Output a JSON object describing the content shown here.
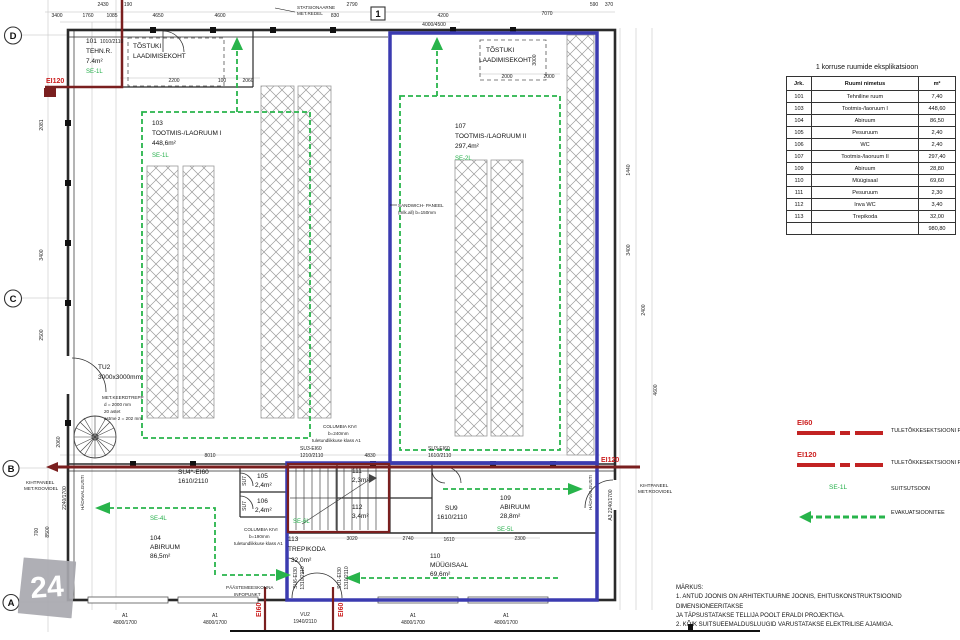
{
  "colors": {
    "section_blue": "#3b3bb0",
    "fire_barrier_maroon": "#7a1f1f",
    "fire_label_red": "#cc2020",
    "evacuation_green": "#28b44b",
    "rack_gray": "#999999"
  },
  "watermark": "24",
  "table": {
    "title": "1 korruse ruumide eksplikatsioon",
    "headers": [
      "Jrk.",
      "Ruumi nimetus",
      "m²"
    ],
    "rows": [
      [
        "101",
        "Tehniline ruum",
        "7,40"
      ],
      [
        "103",
        "Tootmis-/laoruum I",
        "448,60"
      ],
      [
        "104",
        "Abiruum",
        "86,50"
      ],
      [
        "105",
        "Pesuruum",
        "2,40"
      ],
      [
        "106",
        "WC",
        "2,40"
      ],
      [
        "107",
        "Tootmis-/laoruum II",
        "297,40"
      ],
      [
        "109",
        "Abiruum",
        "28,80"
      ],
      [
        "110",
        "Müügisaal",
        "69,60"
      ],
      [
        "111",
        "Pesuruum",
        "2,30"
      ],
      [
        "112",
        "Inva WC",
        "3,40"
      ],
      [
        "113",
        "Trepikoda",
        "32,00"
      ]
    ],
    "total": "980,80"
  },
  "legend": {
    "items": [
      {
        "code": "EI60",
        "label": "TULETÕKKESEKTSIOONI PIIR"
      },
      {
        "code": "EI120",
        "label": "TULETÕKKESEKTSIOONI PIIR"
      },
      {
        "code": "SE-1L",
        "label": "SUITSUTSOON"
      },
      {
        "code": "",
        "label": "EVAKUATSIOONITEE"
      }
    ]
  },
  "notes": {
    "heading": "MÄRKUS:",
    "lines": [
      "1. ANTUD JOONIS ON ARHITEKTUURNE JOONIS, EHITUSKONSTRUKTSIOONID DIMENSIONEERITAKSE",
      "JA TÄPSUSTATAKSE TELLIJA POOLT ERALDI PROJEKTIGA.",
      "2. KÕIK SUITSUEEMALDUSLUUGID VARUSTATAKSE ELEKTRILISE AJAMIGA."
    ]
  },
  "plan_labels": [
    {
      "t": "D",
      "x": 13,
      "y": 39,
      "c": "grid",
      "m": 1
    },
    {
      "t": "C",
      "x": 13,
      "y": 302,
      "c": "grid",
      "m": 1
    },
    {
      "t": "B",
      "x": 11,
      "y": 472,
      "c": "grid",
      "m": 1
    },
    {
      "t": "A",
      "x": 11,
      "y": 606,
      "c": "grid",
      "m": 1
    },
    {
      "t": "1",
      "x": 378,
      "y": 17,
      "c": "grid",
      "m": 1
    },
    {
      "t": "STATSIONAARNE",
      "x": 297,
      "y": 9,
      "c": "tiny"
    },
    {
      "t": "MET.REDEL",
      "x": 297,
      "y": 15,
      "c": "tiny"
    },
    {
      "t": "101",
      "x": 86,
      "y": 43,
      "c": "rm"
    },
    {
      "t": "1010/2110",
      "x": 100,
      "y": 43,
      "c": "dim"
    },
    {
      "t": "TEHN.R.",
      "x": 86,
      "y": 53,
      "c": "rm"
    },
    {
      "t": "7.4m²",
      "x": 86,
      "y": 63,
      "c": "rm"
    },
    {
      "t": "SE-1L",
      "x": 86,
      "y": 73,
      "c": "grn"
    },
    {
      "t": "TÕSTUKI",
      "x": 133,
      "y": 48,
      "c": "rm"
    },
    {
      "t": "LAADIMISEKOHT",
      "x": 133,
      "y": 58,
      "c": "rm"
    },
    {
      "t": "TÕSTUKI",
      "x": 486,
      "y": 52,
      "c": "rm"
    },
    {
      "t": "LAADIMISEKOHT",
      "x": 479,
      "y": 62,
      "c": "rm"
    },
    {
      "t": "103",
      "x": 152,
      "y": 125,
      "c": "rm"
    },
    {
      "t": "TOOTMIS-/LAORUUM I",
      "x": 152,
      "y": 135,
      "c": "rm"
    },
    {
      "t": "448,6m²",
      "x": 152,
      "y": 145,
      "c": "rm"
    },
    {
      "t": "SE-1L",
      "x": 152,
      "y": 157,
      "c": "grn"
    },
    {
      "t": "107",
      "x": 455,
      "y": 128,
      "c": "rm"
    },
    {
      "t": "TOOTMIS-/LAORUUM II",
      "x": 455,
      "y": 138,
      "c": "rm"
    },
    {
      "t": "297,4m²",
      "x": 455,
      "y": 148,
      "c": "rm"
    },
    {
      "t": "SE-2L",
      "x": 455,
      "y": 160,
      "c": "grn"
    },
    {
      "t": "104",
      "x": 150,
      "y": 540,
      "c": "rm"
    },
    {
      "t": "ABIRUUM",
      "x": 150,
      "y": 549,
      "c": "rm"
    },
    {
      "t": "86,5m²",
      "x": 150,
      "y": 558,
      "c": "rm"
    },
    {
      "t": "SE-4L",
      "x": 150,
      "y": 520,
      "c": "grn"
    },
    {
      "t": "113",
      "x": 288,
      "y": 541,
      "c": "rm"
    },
    {
      "t": "TREPIKODA",
      "x": 288,
      "y": 551,
      "c": "rm"
    },
    {
      "t": "32,0m²",
      "x": 291,
      "y": 562,
      "c": "rm"
    },
    {
      "t": "SE-6L",
      "x": 293,
      "y": 523,
      "c": "grn"
    },
    {
      "t": "109",
      "x": 500,
      "y": 500,
      "c": "rm"
    },
    {
      "t": "ABIRUUM",
      "x": 500,
      "y": 509,
      "c": "rm"
    },
    {
      "t": "28,8m²",
      "x": 500,
      "y": 518,
      "c": "rm"
    },
    {
      "t": "SE-5L",
      "x": 497,
      "y": 531,
      "c": "grn"
    },
    {
      "t": "110",
      "x": 430,
      "y": 558,
      "c": "rm"
    },
    {
      "t": "MÜÜGISAAL",
      "x": 430,
      "y": 567,
      "c": "rm"
    },
    {
      "t": "69,6m²",
      "x": 430,
      "y": 576,
      "c": "rm"
    },
    {
      "t": "111",
      "x": 352,
      "y": 473,
      "c": "rm"
    },
    {
      "t": "2,3m²",
      "x": 352,
      "y": 482,
      "c": "rm"
    },
    {
      "t": "112",
      "x": 352,
      "y": 509,
      "c": "rm"
    },
    {
      "t": "3,4m²",
      "x": 352,
      "y": 518,
      "c": "rm"
    },
    {
      "t": "105",
      "x": 257,
      "y": 478,
      "c": "rm"
    },
    {
      "t": "2,4m²",
      "x": 255,
      "y": 487,
      "c": "rm"
    },
    {
      "t": "106",
      "x": 257,
      "y": 503,
      "c": "rm"
    },
    {
      "t": "2,4m²",
      "x": 255,
      "y": 512,
      "c": "rm"
    },
    {
      "t": "TU2",
      "x": 98,
      "y": 369,
      "c": "rm"
    },
    {
      "t": "3000x3000mm",
      "x": 98,
      "y": 379,
      "c": "rm"
    },
    {
      "t": "MET.KEERDTREPP",
      "x": 102,
      "y": 399,
      "c": "tiny"
    },
    {
      "t": "d = 2000 mm",
      "x": 104,
      "y": 406,
      "c": "tiny"
    },
    {
      "t": "20 astet",
      "x": 104,
      "y": 413,
      "c": "tiny"
    },
    {
      "t": "astme 2 = 202 mm",
      "x": 104,
      "y": 420,
      "c": "tiny"
    },
    {
      "t": "SANDWICH- PANEEL",
      "x": 398,
      "y": 207,
      "c": "tiny"
    },
    {
      "t": "(mlk.all) b=150mm",
      "x": 398,
      "y": 214,
      "c": "tiny"
    },
    {
      "t": "COLUMBIA KIVI",
      "x": 323,
      "y": 428,
      "c": "tiny"
    },
    {
      "t": "b=240mm",
      "x": 328,
      "y": 435,
      "c": "tiny"
    },
    {
      "t": "tuletundlikkuse klass A1",
      "x": 312,
      "y": 442,
      "c": "tiny"
    },
    {
      "t": "COLUMBIA KIVI",
      "x": 244,
      "y": 531,
      "c": "tiny"
    },
    {
      "t": "b=190mm",
      "x": 249,
      "y": 538,
      "c": "tiny"
    },
    {
      "t": "tuletundlikkuse klass A1",
      "x": 234,
      "y": 545,
      "c": "tiny"
    },
    {
      "t": "SU4*-EI60",
      "x": 178,
      "y": 474,
      "c": "rm"
    },
    {
      "t": "1610/2110",
      "x": 178,
      "y": 483,
      "c": "rm"
    },
    {
      "t": "SU3-EI60",
      "x": 300,
      "y": 450,
      "c": "dim"
    },
    {
      "t": "1210/2110",
      "x": 300,
      "y": 457,
      "c": "dim"
    },
    {
      "t": "SU3-EI60",
      "x": 428,
      "y": 450,
      "c": "dim"
    },
    {
      "t": "1610/2110",
      "x": 428,
      "y": 457,
      "c": "dim"
    },
    {
      "t": "SU9",
      "x": 445,
      "y": 510,
      "c": "rm"
    },
    {
      "t": "1610/2110",
      "x": 437,
      "y": 519,
      "c": "rm"
    },
    {
      "t": "SU7",
      "x": 246,
      "y": 481,
      "r": -90,
      "c": "dim",
      "m": 1
    },
    {
      "t": "SU7",
      "x": 246,
      "y": 506,
      "r": -90,
      "c": "dim",
      "m": 1
    },
    {
      "t": "SU6-EI30",
      "x": 297,
      "y": 578,
      "r": -90,
      "c": "dim",
      "m": 1
    },
    {
      "t": "1310/2110",
      "x": 304,
      "y": 578,
      "r": -90,
      "c": "dim",
      "m": 1
    },
    {
      "t": "SU1-EI30",
      "x": 341,
      "y": 578,
      "r": -90,
      "c": "dim",
      "m": 1
    },
    {
      "t": "1310/2110",
      "x": 348,
      "y": 578,
      "r": -90,
      "c": "dim",
      "m": 1
    },
    {
      "t": "EI120",
      "x": 46,
      "y": 83,
      "c": "red"
    },
    {
      "t": "EI120",
      "x": 601,
      "y": 462,
      "c": "red"
    },
    {
      "t": "EI60",
      "x": 261,
      "y": 617,
      "r": -90,
      "c": "red"
    },
    {
      "t": "EI60",
      "x": 343,
      "y": 617,
      "r": -90,
      "c": "red"
    },
    {
      "t": "PÄÄSTEMEESKONNA",
      "x": 226,
      "y": 589,
      "c": "tiny"
    },
    {
      "t": "INFOPUNKT",
      "x": 234,
      "y": 596,
      "c": "tiny"
    },
    {
      "t": "KIHTPANEEL",
      "x": 26,
      "y": 484,
      "c": "tiny"
    },
    {
      "t": "MET.ROOVIDEL",
      "x": 24,
      "y": 490,
      "c": "tiny"
    },
    {
      "t": "KIHTPANEEL",
      "x": 640,
      "y": 487,
      "c": "tiny"
    },
    {
      "t": "MET.ROOVIDEL",
      "x": 638,
      "y": 493,
      "c": "tiny"
    },
    {
      "t": "HÄDAVALGUSTI",
      "x": 84,
      "y": 510,
      "r": -90,
      "c": "tiny"
    },
    {
      "t": "HÄDAVALGUSTI",
      "x": 592,
      "y": 510,
      "r": -90,
      "c": "tiny"
    },
    {
      "t": "A3 2240/1700",
      "x": 612,
      "y": 505,
      "r": -90,
      "c": "dim",
      "m": 1
    },
    {
      "t": "2240/1700",
      "x": 66,
      "y": 498,
      "r": -90,
      "c": "dim",
      "m": 1
    },
    {
      "t": "A1",
      "x": 125,
      "y": 617,
      "c": "dim",
      "m": 1
    },
    {
      "t": "4800/1700",
      "x": 125,
      "y": 624,
      "c": "dim",
      "m": 1
    },
    {
      "t": "A1",
      "x": 215,
      "y": 617,
      "c": "dim",
      "m": 1
    },
    {
      "t": "4800/1700",
      "x": 215,
      "y": 624,
      "c": "dim",
      "m": 1
    },
    {
      "t": "VU2",
      "x": 305,
      "y": 616,
      "c": "dim",
      "m": 1
    },
    {
      "t": "1940/2110",
      "x": 305,
      "y": 623,
      "c": "dim",
      "m": 1
    },
    {
      "t": "A1",
      "x": 413,
      "y": 617,
      "c": "dim",
      "m": 1
    },
    {
      "t": "4800/1700",
      "x": 413,
      "y": 624,
      "c": "dim",
      "m": 1
    },
    {
      "t": "A1",
      "x": 506,
      "y": 617,
      "c": "dim",
      "m": 1
    },
    {
      "t": "4800/1700",
      "x": 506,
      "y": 624,
      "c": "dim",
      "m": 1
    },
    {
      "t": "3400",
      "x": 57,
      "y": 17,
      "c": "dim",
      "m": 1
    },
    {
      "t": "2430",
      "x": 103,
      "y": 6,
      "c": "dim",
      "m": 1
    },
    {
      "t": "190",
      "x": 128,
      "y": 6,
      "c": "dim",
      "m": 1
    },
    {
      "t": "1760",
      "x": 88,
      "y": 17,
      "c": "dim",
      "m": 1
    },
    {
      "t": "1085",
      "x": 112,
      "y": 17,
      "c": "dim",
      "m": 1
    },
    {
      "t": "4650",
      "x": 158,
      "y": 17,
      "c": "dim",
      "m": 1
    },
    {
      "t": "4600",
      "x": 220,
      "y": 17,
      "c": "dim",
      "m": 1
    },
    {
      "t": "2790",
      "x": 352,
      "y": 6,
      "c": "dim",
      "m": 1
    },
    {
      "t": "830",
      "x": 335,
      "y": 17,
      "c": "dim",
      "m": 1
    },
    {
      "t": "4200",
      "x": 443,
      "y": 17,
      "c": "dim",
      "m": 1
    },
    {
      "t": "4000/4500",
      "x": 434,
      "y": 26,
      "c": "dim",
      "m": 1
    },
    {
      "t": "7070",
      "x": 547,
      "y": 15,
      "c": "dim",
      "m": 1
    },
    {
      "t": "590",
      "x": 594,
      "y": 6,
      "c": "dim",
      "m": 1
    },
    {
      "t": "370",
      "x": 609,
      "y": 6,
      "c": "dim",
      "m": 1
    },
    {
      "t": "2200",
      "x": 174,
      "y": 82,
      "c": "dim",
      "m": 1
    },
    {
      "t": "100",
      "x": 222,
      "y": 82,
      "c": "dim",
      "m": 1
    },
    {
      "t": "2060",
      "x": 248,
      "y": 82,
      "c": "dim",
      "m": 1
    },
    {
      "t": "2000",
      "x": 507,
      "y": 78,
      "c": "dim",
      "m": 1
    },
    {
      "t": "2000",
      "x": 549,
      "y": 78,
      "c": "dim",
      "m": 1
    },
    {
      "t": "3000",
      "x": 536,
      "y": 60,
      "r": -90,
      "c": "dim",
      "m": 1
    },
    {
      "t": "8010",
      "x": 210,
      "y": 457,
      "c": "dim",
      "m": 1
    },
    {
      "t": "4830",
      "x": 370,
      "y": 457,
      "c": "dim",
      "m": 1
    },
    {
      "t": "3020",
      "x": 352,
      "y": 540,
      "c": "dim",
      "m": 1
    },
    {
      "t": "2740",
      "x": 408,
      "y": 540,
      "c": "dim",
      "m": 1
    },
    {
      "t": "1610",
      "x": 449,
      "y": 541,
      "c": "dim",
      "m": 1
    },
    {
      "t": "2300",
      "x": 520,
      "y": 540,
      "c": "dim",
      "m": 1
    },
    {
      "t": "2081",
      "x": 43,
      "y": 125,
      "r": -90,
      "c": "dim",
      "m": 1
    },
    {
      "t": "3400",
      "x": 43,
      "y": 255,
      "r": -90,
      "c": "dim",
      "m": 1
    },
    {
      "t": "2500",
      "x": 43,
      "y": 335,
      "r": -90,
      "c": "dim",
      "m": 1
    },
    {
      "t": "2060",
      "x": 60,
      "y": 442,
      "r": -90,
      "c": "dim",
      "m": 1
    },
    {
      "t": "700",
      "x": 38,
      "y": 532,
      "r": -90,
      "c": "dim",
      "m": 1
    },
    {
      "t": "8500",
      "x": 49,
      "y": 532,
      "r": -90,
      "c": "dim",
      "m": 1
    },
    {
      "t": "1440",
      "x": 630,
      "y": 170,
      "r": -90,
      "c": "dim",
      "m": 1
    },
    {
      "t": "3400",
      "x": 630,
      "y": 250,
      "r": -90,
      "c": "dim",
      "m": 1
    },
    {
      "t": "2400",
      "x": 645,
      "y": 310,
      "r": -90,
      "c": "dim",
      "m": 1
    },
    {
      "t": "4600",
      "x": 657,
      "y": 390,
      "r": -90,
      "c": "dim",
      "m": 1
    }
  ]
}
